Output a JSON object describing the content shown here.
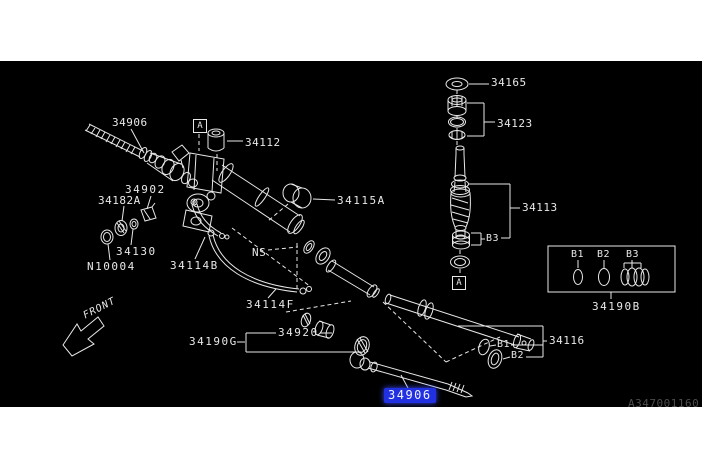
{
  "colors": {
    "page_bg": "#ffffff",
    "canvas_bg": "#000000",
    "line": "#e8e8e8",
    "highlight_bg": "#2130e0",
    "highlight_fg": "#f0f4ff",
    "watermark": "#4d4d4d"
  },
  "parts": {
    "p34906": "34906",
    "p34112": "34112",
    "p34902": "34902",
    "p34182A": "34182A",
    "p34130": "34130",
    "pN10004": "N10004",
    "p34114B": "34114B",
    "p34115A": "34115A",
    "p34114F": "34114F",
    "p34190G": "34190G",
    "p34920": "34920",
    "p34165": "34165",
    "p34123": "34123",
    "p34113": "34113",
    "p34116": "34116",
    "p34190B": "34190B"
  },
  "callouts": {
    "marker_a": "A",
    "ns": "NS",
    "b1": "B1",
    "b2": "B2",
    "b3": "B3"
  },
  "legend": {
    "b1": "B1",
    "b2": "B2",
    "b3": "B3",
    "code": "34190B"
  },
  "highlight": {
    "part": "34906"
  },
  "front_indicator": "FRONT",
  "watermark": "A347001160"
}
